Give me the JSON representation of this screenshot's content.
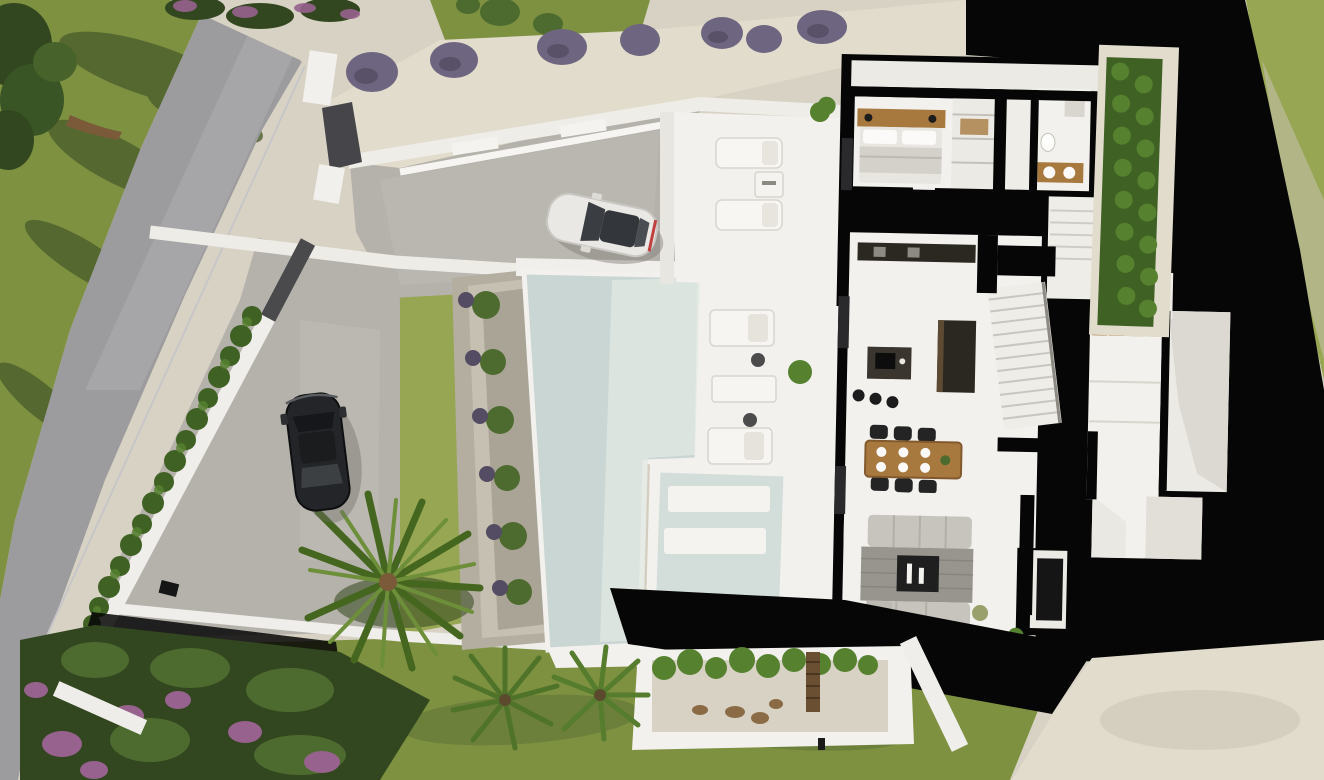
{
  "scene": {
    "type": "aerial-3d-architectural-render",
    "subject": "Top-down cutaway render of a modern villa plot with swimming pool, garden, road and two parked cars",
    "view": "top-down aerial"
  },
  "palette": {
    "grass": "#7d9140",
    "grassDark": "#66793a",
    "grassLight": "#97a652",
    "shadowGreen": "#4c5f2c",
    "road": "#9c9b9d",
    "roadLight": "#aeadaf",
    "paver": "#b5b1ab",
    "gravel": "#d8d2c4",
    "gravelLight": "#e2dccd",
    "stone": "#b3aea0",
    "white": "#f2f1ed",
    "whiteShade": "#ddดbd5",
    "whiteShade2": "#dedbd4",
    "black": "#060606",
    "darkWall": "#46464a",
    "hedge": "#56812f",
    "hedgeDark": "#3f6124",
    "lavender": "#6e6680",
    "lavenderDark": "#534c62",
    "flower": "#97628d",
    "foliage": "#4e6b2f",
    "foliageDark": "#32471f",
    "pool": "#c9d6d3",
    "poolLight": "#e2e8e3",
    "spa": "#d3deda",
    "wood": "#a8793f",
    "woodDark": "#6b4f33",
    "kitchenDark": "#2b2721",
    "sofa": "#c7c4be",
    "stoneWall": "#98958f",
    "fire": "#1f1f1f",
    "tv": "#151515",
    "carWhite": "#e9e8e5",
    "carBlack": "#232528",
    "glassDark": "#33373b",
    "trunk": "#7a5a38",
    "rug": "#d9cdb6",
    "deckTable": "#4c4c4c"
  },
  "objects": {
    "road": "curved asphalt road",
    "lawn_front": "front lawn with tree and branch shadows",
    "tree_corner": "large tree, top-left corner",
    "lavender_row": "lavender bushes on gravel slope",
    "retaining_walls": "white stepped retaining walls and entrance gate",
    "driveway": "paved driveway",
    "car_white": "white sports car on driveway",
    "car_black": "black car on lower parking",
    "hedge_road": "cypress hedge along boundary wall",
    "hedge_house": "hedge strip along right side of house",
    "pool": "large swimming pool",
    "pool_planters": "stepped planter terraces beside pool",
    "spa": "sunken spa / plunge pool with benches",
    "deck": "pool deck with two daybeds, side tables and planter",
    "terrace_upper": "upper terrace with two sun loungers and table",
    "villa": "cutaway floor plan of villa",
    "bedroom": "bedroom with double bed and wall lamps",
    "wardrobe": "wardrobe / walk-in closet",
    "bathroom": "bathroom with twin vanity",
    "kitchen": "kitchen with dark island, hob and three bar stools",
    "dining": "wooden dining table with six black chairs",
    "stairs": "white staircase",
    "living": "living room with two sofas and stone fireplace wall",
    "tv_panel": "wall-mounted TV panel",
    "garage_room": "white utility / garage room",
    "patio_plants": "interior patio greenery",
    "courtyard": "gravel courtyard planter with shrubs and timber gate",
    "palm_large": "large palm tree",
    "palm_fans": "two fan palms",
    "flower_garden": "flower garden with purple blooms, bottom-left",
    "shadow_cast": "deep black cast shadows of the building"
  }
}
